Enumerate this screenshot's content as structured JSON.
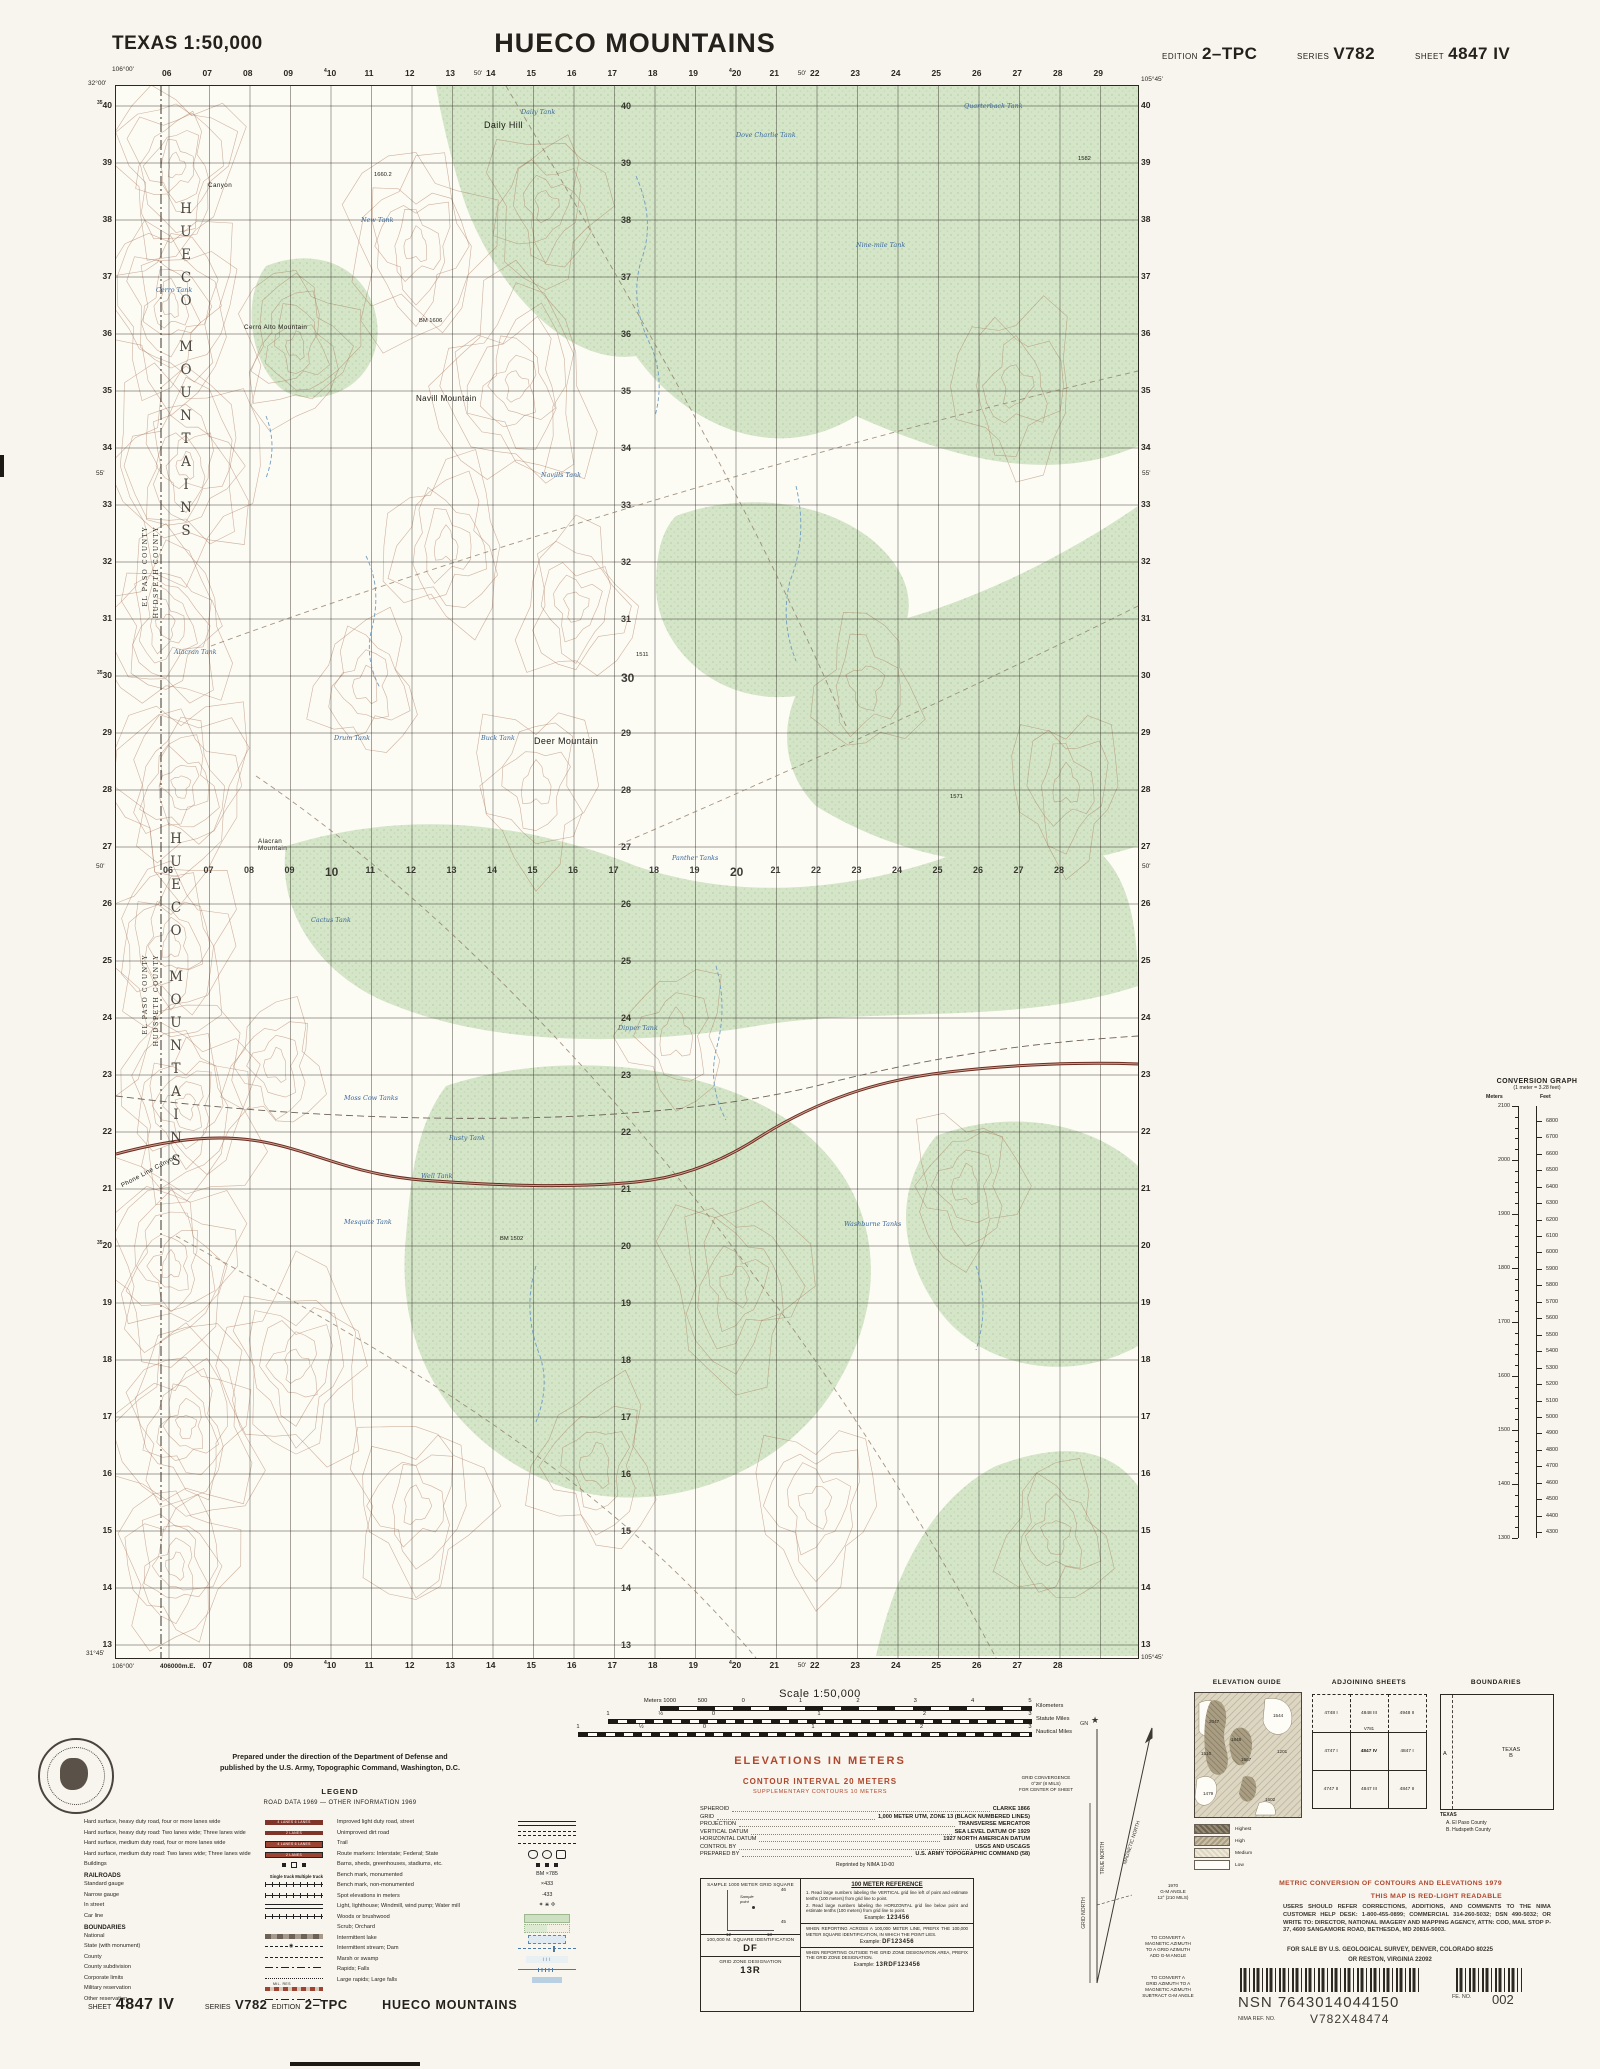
{
  "header": {
    "region": "TEXAS 1:50,000",
    "title": "HUECO MOUNTAINS",
    "edition_label": "EDITION",
    "edition": "2–TPC",
    "series_label": "SERIES",
    "series": "V782",
    "sheet_label": "SHEET",
    "sheet": "4847 IV"
  },
  "map": {
    "corners": {
      "tl_lon": "106°00'",
      "tl_lat": "32°00'",
      "tr_lon": "105°45'",
      "bl_lat": "31°45'",
      "bl_lon": "106°00'",
      "bl_utm": "406000m.E.",
      "br_lon": "105°45'"
    },
    "grid": {
      "eastings": [
        "06",
        "07",
        "08",
        "09",
        "10",
        "11",
        "12",
        "13",
        "14",
        "15",
        "16",
        "17",
        "18",
        "19",
        "20",
        "21",
        "22",
        "23",
        "24",
        "25",
        "26",
        "27",
        "28",
        "29"
      ],
      "sup_eastings": {
        "10": "4",
        "20": "4"
      },
      "northings": [
        "40",
        "39",
        "38",
        "37",
        "36",
        "35",
        "34",
        "33",
        "32",
        "31",
        "30",
        "29",
        "28",
        "27",
        "26",
        "25",
        "24",
        "23",
        "22",
        "21",
        "20",
        "19",
        "18",
        "17",
        "16",
        "15",
        "14",
        "13"
      ],
      "sup_northings": {
        "40": "35",
        "30": "35",
        "20": "35"
      },
      "bottom_eastings": [
        "07",
        "08",
        "09",
        "10",
        "11",
        "12",
        "13",
        "14",
        "15",
        "16",
        "17",
        "18",
        "19",
        "20",
        "21",
        "22",
        "23",
        "24",
        "25",
        "26",
        "27",
        "28"
      ],
      "mid_eastings": [
        "06",
        "07",
        "08",
        "09",
        "10",
        "11",
        "12",
        "13",
        "14",
        "15",
        "16",
        "17",
        "18",
        "19",
        "20",
        "21",
        "22",
        "23",
        "24",
        "25",
        "26",
        "27",
        "28"
      ],
      "top_minutes": [
        {
          "t": "50'",
          "i": 7.55
        },
        {
          "t": "50'",
          "i": 15.55
        }
      ],
      "bottom_minutes": [
        {
          "t": "50'",
          "i": 15.55
        }
      ],
      "left_minutes": [
        {
          "t": "55'",
          "j": 6.4
        },
        {
          "t": "50'",
          "j": 13.3
        }
      ],
      "right_minutes": [
        {
          "t": "55'",
          "j": 6.4
        },
        {
          "t": "50'",
          "j": 13.3
        }
      ]
    },
    "labels": {
      "places": [
        {
          "t": "Daily Hill",
          "x": 368,
          "y": 34,
          "c": "lg"
        },
        {
          "t": "Canyon",
          "x": 92,
          "y": 96,
          "c": "sm"
        },
        {
          "t": "Cerro Alto Mountain",
          "x": 128,
          "y": 238,
          "c": "sm"
        },
        {
          "t": "Navill Mountain",
          "x": 300,
          "y": 308,
          "c": ""
        },
        {
          "t": "Deer Mountain",
          "x": 418,
          "y": 650,
          "c": "lg"
        },
        {
          "t": "Alacran\nMountain",
          "x": 142,
          "y": 752,
          "c": "sm"
        },
        {
          "t": "Phone Line Canyon",
          "x": 2,
          "y": 1082,
          "c": "sm",
          "r": -28
        }
      ],
      "waters": [
        {
          "t": "Daily Tank",
          "x": 405,
          "y": 22
        },
        {
          "t": "Dove Charlie Tank",
          "x": 620,
          "y": 45
        },
        {
          "t": "Quarterback Tank",
          "x": 848,
          "y": 16
        },
        {
          "t": "New Tank",
          "x": 245,
          "y": 130
        },
        {
          "t": "Nine-mile Tank",
          "x": 740,
          "y": 155
        },
        {
          "t": "Cerro Tank",
          "x": 40,
          "y": 200
        },
        {
          "t": "Alacran Tank",
          "x": 58,
          "y": 562
        },
        {
          "t": "Navills Tank",
          "x": 425,
          "y": 385
        },
        {
          "t": "Drum Tank",
          "x": 218,
          "y": 648
        },
        {
          "t": "Buck Tank",
          "x": 365,
          "y": 648
        },
        {
          "t": "Panther Tanks",
          "x": 556,
          "y": 768
        },
        {
          "t": "Cactus Tank",
          "x": 195,
          "y": 830
        },
        {
          "t": "Dipper Tank",
          "x": 502,
          "y": 938
        },
        {
          "t": "Moss Cow Tanks",
          "x": 228,
          "y": 1008
        },
        {
          "t": "Rusty Tank",
          "x": 333,
          "y": 1048
        },
        {
          "t": "Well Tank",
          "x": 305,
          "y": 1086
        },
        {
          "t": "Mesquite Tank",
          "x": 228,
          "y": 1132
        },
        {
          "t": "Washburne Tanks",
          "x": 728,
          "y": 1134
        }
      ],
      "spots": [
        {
          "t": "1660.2",
          "x": 258,
          "y": 86
        },
        {
          "t": "BM 1606",
          "x": 303,
          "y": 232
        },
        {
          "t": "1582",
          "x": 962,
          "y": 70
        },
        {
          "t": "1511",
          "x": 520,
          "y": 566
        },
        {
          "t": "1571",
          "x": 834,
          "y": 708
        },
        {
          "t": "BM 1502",
          "x": 384,
          "y": 1150
        }
      ],
      "mountain_text": "HUECO MOUNTAINS",
      "county_a": "EL PASO COUNTY",
      "county_b": "HUDSPETH COUNTY"
    }
  },
  "conversion": {
    "title": "CONVERSION GRAPH",
    "note": "(1 meter = 3.28 feet)",
    "meters_h": "Meters",
    "feet_h": "Feet",
    "meters": [
      2100,
      2000,
      1900,
      1800,
      1700,
      1600,
      1500,
      1400,
      1300
    ],
    "feet": [
      6800,
      6700,
      6600,
      6500,
      6400,
      6300,
      6200,
      6100,
      6000,
      5900,
      5800,
      5700,
      5600,
      5500,
      5400,
      5300,
      5200,
      5100,
      5000,
      4900,
      4800,
      4700,
      4600,
      4500,
      4400,
      4300
    ]
  },
  "credits": {
    "line1": "Prepared under the direction of the Department of Defense and",
    "line2": "published by the U.S. Army, Topographic Command, Washington, D.C.",
    "legend_title": "LEGEND",
    "road_data": "ROAD DATA 1969 — OTHER INFORMATION 1969"
  },
  "legend": {
    "left": [
      {
        "t": "Hard surface, heavy duty road, four or more lanes wide",
        "sym": "band4"
      },
      {
        "t": "Hard surface, heavy duty road: Two lanes wide; Three lanes wide",
        "sym": "band2"
      },
      {
        "t": "Hard surface, medium duty road, four or more lanes wide",
        "sym": "band4m"
      },
      {
        "t": "Hard surface, medium duty road: Two lanes wide; Three lanes wide",
        "sym": "band2m"
      },
      {
        "t": "Buildings",
        "sym": "bldg"
      },
      {
        "h": "RAILROADS",
        "cols": "Single track      Multiple track"
      },
      {
        "t": "Standard gauge",
        "sym": "rrstd"
      },
      {
        "t": "Narrow gauge",
        "sym": "rrnar"
      },
      {
        "t": "In street",
        "sym": "rrstr"
      },
      {
        "t": "Car line",
        "sym": "rrcar"
      },
      {
        "h": "BOUNDARIES"
      },
      {
        "t": "National",
        "sym": "natl"
      },
      {
        "t": "State (with monument)",
        "sym": "state"
      },
      {
        "t": "County",
        "sym": "county"
      },
      {
        "t": "County subdivision",
        "sym": "csub"
      },
      {
        "t": "Corporate limits",
        "sym": "corp"
      },
      {
        "t": "Military reservation",
        "sym": "milres",
        "s": "MIL. RES"
      },
      {
        "t": "Other reservation",
        "sym": "other"
      }
    ],
    "right": [
      {
        "t": "Improved light duty road, street",
        "sym": "lightrd"
      },
      {
        "t": "Unimproved dirt road",
        "sym": "dirt"
      },
      {
        "t": "Trail",
        "sym": "trail"
      },
      {
        "t": "Route markers: Interstate; Federal; State",
        "sym": "routes"
      },
      {
        "t": "Barns, sheds, greenhouses, stadiums, etc.",
        "sym": "barns"
      },
      {
        "t": "Bench mark, monumented",
        "sym": "txt",
        "s": "BM ×785"
      },
      {
        "t": "Bench mark, non-monumented",
        "sym": "txt",
        "s": "×433"
      },
      {
        "t": "Spot elevations in meters",
        "sym": "txt",
        "s": "·433"
      },
      {
        "t": "Light, lighthouse; Windmill, wind pump; Water mill",
        "sym": "txt",
        "s": "✶  ⋇  ✢"
      },
      {
        "t": "Woods or brushwood",
        "sym": "woods"
      },
      {
        "t": "Scrub; Orchard",
        "sym": "scrub"
      },
      {
        "t": "Intermittent lake",
        "sym": "ilake"
      },
      {
        "t": "Intermittent stream; Dam",
        "sym": "istream"
      },
      {
        "t": "Marsh or swamp",
        "sym": "marsh"
      },
      {
        "t": "Rapids; Falls",
        "sym": "rapids"
      },
      {
        "t": "Large rapids; Large falls",
        "sym": "lrapids"
      }
    ]
  },
  "scale": {
    "title": "Scale 1:50,000",
    "bars": [
      {
        "ticks": [
          [
            "Meters 1000",
            0
          ],
          [
            "500",
            0.115
          ],
          [
            "0",
            0.225
          ],
          [
            "1",
            0.38
          ],
          [
            "2",
            0.535
          ],
          [
            "3",
            0.69
          ],
          [
            "4",
            0.845
          ],
          [
            "5",
            1
          ]
        ],
        "unit": "Kilometers",
        "x": 660,
        "w": 370,
        "y": 1706
      },
      {
        "ticks": [
          [
            "1",
            0
          ],
          [
            "½",
            0.125
          ],
          [
            "0",
            0.25
          ],
          [
            "1",
            0.5
          ],
          [
            "2",
            0.75
          ],
          [
            "3",
            1
          ]
        ],
        "unit": "Statute Miles",
        "x": 608,
        "w": 422,
        "y": 1719
      },
      {
        "ticks": [
          [
            "1",
            0
          ],
          [
            "½",
            0.14
          ],
          [
            "0",
            0.28
          ],
          [
            "1",
            0.52
          ],
          [
            "2",
            0.76
          ],
          [
            "3",
            1
          ]
        ],
        "unit": "Nautical Miles",
        "x": 578,
        "w": 452,
        "y": 1732
      }
    ]
  },
  "elevations": {
    "main": "ELEVATIONS  IN  METERS",
    "ci": "CONTOUR INTERVAL 20 METERS",
    "sup": "SUPPLEMENTARY CONTOURS 10 METERS"
  },
  "datum": {
    "rows": [
      {
        "k": "SPHEROID",
        "v": "CLARKE 1866"
      },
      {
        "k": "GRID",
        "v": "1,000 METER UTM, ZONE 13 (BLACK NUMBERED LINES)"
      },
      {
        "k": "PROJECTION",
        "v": "TRANSVERSE MERCATOR"
      },
      {
        "k": "VERTICAL DATUM",
        "v": "SEA LEVEL DATUM OF 1929"
      },
      {
        "k": "HORIZONTAL DATUM",
        "v": "1927 NORTH AMERICAN DATUM"
      },
      {
        "k": "CONTROL BY",
        "v": "USGS AND USC&GS"
      },
      {
        "k": "PREPARED BY",
        "v": "U.S. ARMY TOPOGRAPHIC COMMAND (58)"
      }
    ],
    "reprint": "Reprinted by NIMA 10-00"
  },
  "gridref": {
    "sample_title": "SAMPLE 1000 METER GRID SQUARE",
    "sq_top": "46",
    "sq_bottom": "45",
    "sq_left": "12",
    "sq_right": "13",
    "sample_point": "Sample\npoint",
    "sq_id_label": "100,000 M. SQUARE IDENTIFICATION",
    "sq_id": "DF",
    "zone_label": "GRID ZONE DESIGNATION",
    "zone": "13R",
    "ref_title": "100 METER REFERENCE",
    "step1": "1. Read large numbers labeling the VERTICAL grid line left of point and estimate tenths (100 meters) from grid line to point.",
    "step2": "2. Read large numbers labeling the HORIZONTAL grid line below point and estimate tenths (100 meters) from grid line to point.",
    "ex_label": "Example:",
    "ex1": "123456",
    "para2": "WHEN REPORTING ACROSS A 100,000 METER LINE, PREFIX THE 100,000 METER SQUARE IDENTIFICATION, IN WHICH THE POINT LIES.",
    "ex2": "DF123456",
    "para3": "WHEN REPORTING OUTSIDE THE GRID ZONE DESIGNATION AREA, PREFIX THE GRID ZONE DESIGNATION.",
    "ex3": "13RDF123456"
  },
  "declination": {
    "gn": "GN",
    "true_north": "TRUE NORTH",
    "grid_north": "GRID NORTH",
    "magnetic_north": "MAGNETIC NORTH",
    "convergence": "GRID CONVERGENCE\n0°28' (8 MILS)\nFOR CENTER OF SHEET",
    "gm": "1970\nG-M ANGLE\n12° (210 MILS)",
    "note1": "TO CONVERT A\nMAGNETIC AZIMUTH\nTO A GRID AZIMUTH\nADD G-M ANGLE",
    "note2": "TO CONVERT A\nGRID AZIMUTH TO A\nMAGNETIC AZIMUTH\nSUBTRACT G-M ANGLE"
  },
  "panels": {
    "elevation_guide": {
      "title": "ELEVATION GUIDE",
      "values": [
        {
          "t": "2047",
          "x": 14,
          "y": 26
        },
        {
          "t": "1848",
          "x": 36,
          "y": 44
        },
        {
          "t": "1544",
          "x": 78,
          "y": 20
        },
        {
          "t": "1510",
          "x": 6,
          "y": 58
        },
        {
          "t": "1667",
          "x": 46,
          "y": 64
        },
        {
          "t": "1201",
          "x": 82,
          "y": 56
        },
        {
          "t": "1479",
          "x": 8,
          "y": 98
        },
        {
          "t": "1602",
          "x": 70,
          "y": 104
        }
      ],
      "swatches": [
        "Highest",
        "High",
        "Medium",
        "Low"
      ]
    },
    "adjoining": {
      "title": "ADJOINING SHEETS",
      "series_note": "V781",
      "cells": [
        "4748 I",
        "4848 III",
        "4948 II",
        "4747 I",
        "4847 IV",
        "4847 I",
        "4747 II",
        "4847 III",
        "4847 II"
      ]
    },
    "boundaries": {
      "title": "BOUNDARIES",
      "state": "TEXAS",
      "a": "A",
      "b": "B",
      "list_title": "TEXAS",
      "list_a": "A. El Paso County",
      "list_b": "B. Hudspeth County"
    }
  },
  "notes": {
    "metric": "METRIC  CONVERSION  OF  CONTOURS  AND  ELEVATIONS  1979",
    "redlight": "THIS  MAP  IS  RED-LIGHT  READABLE",
    "users": "USERS SHOULD REFER CORRECTIONS, ADDITIONS, AND COMMENTS TO THE NIMA CUSTOMER HELP DESK: 1-800-455-0899; COMMERCIAL 314-260-5032; DSN 490-5032; OR WRITE TO: DIRECTOR, NATIONAL IMAGERY AND MAPPING AGENCY, ATTN: COD, MAIL STOP P-37, 4600 SANGAMORE ROAD, BETHESDA, MD 20816-5003.",
    "sale1": "FOR SALE BY U.S. GEOLOGICAL SURVEY, DENVER, COLORADO 80225",
    "sale2": "OR RESTON, VIRGINIA 22092"
  },
  "nsn": {
    "nsn_label": "NSN",
    "nsn": "7643014044150",
    "fe_label": "FE. NO.",
    "fe": "002",
    "ref_label": "NIMA REF. NO.",
    "ref": "V782X48474"
  },
  "footer": {
    "sheet_label": "SHEET",
    "sheet": "4847 IV",
    "series_label": "SERIES",
    "series": "V782",
    "edition_label": "EDITION",
    "edition": "2–TPC",
    "title": "HUECO MOUNTAINS"
  }
}
